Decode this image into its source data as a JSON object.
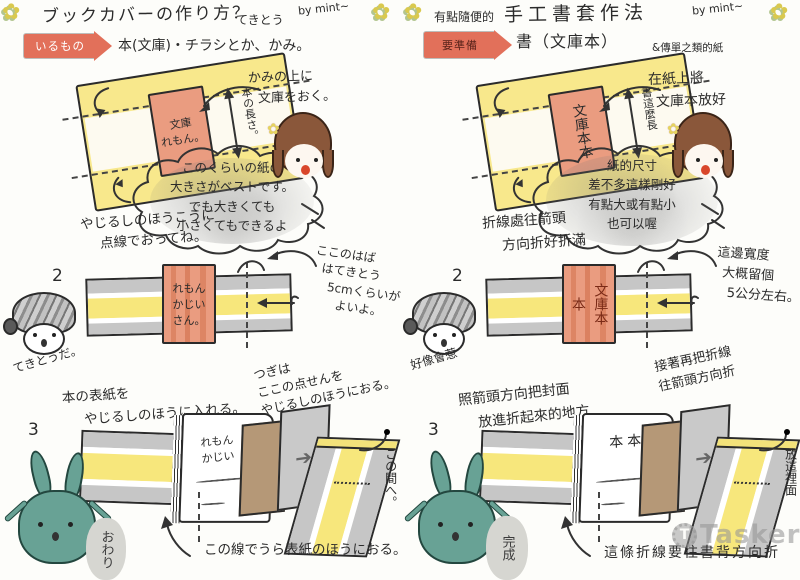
{
  "watermark": {
    "brand": "Tasker"
  },
  "icons": {
    "flower_doodle": "✿",
    "hand_drawn_arrow": "➔",
    "watermark_gear_letter": "T"
  },
  "colors": {
    "badge_red": "#e2705a",
    "paper_yellow": "#f8e88c",
    "book_pink": "#ea9c80",
    "band_gray": "#c6c6c6",
    "fold_tan": "#b59877",
    "rabbit_green": "#68a295",
    "hair_brown": "#8a573a"
  },
  "panels": [
    {
      "title_pre": "",
      "title_main": "ブックカバーの作り方？",
      "title_tail": "てきとう",
      "title_by": "by mint~",
      "badge": "いるもの",
      "materials_main": "本(文庫)・チラシとか、かみ。",
      "materials_sub": "",
      "step1_num": "1.",
      "step1_note1": "かみの上に",
      "step1_note2": "文庫をおく。",
      "step1_book": "文庫\nれもん。",
      "step1_length": "本の長さ。",
      "step1_fold1": "やじるしのほうこうに",
      "step1_fold2": "点線でおってね。",
      "cloud1": "このくらいの紙の",
      "cloud2": "大きさがベストです。",
      "cloud3": "でも大きくても",
      "cloud4": "小さくてもできるよ",
      "step2_num": "2",
      "step2_char": "てきとうだ。",
      "step2_book": "れもん\nかじい\nさん。",
      "step2_width1": "ここのはば",
      "step2_width2": "はてきとう",
      "step2_width3": "5cmくらいが",
      "step2_width4": "よいよ。",
      "step2_next1": "つぎは",
      "step2_next2": "ここの点せんを",
      "step2_next3": "やじるしのほうにおる。",
      "step2_insert1": "本の表紙を",
      "step2_insert2": "やじるしのほうに入れる。",
      "step3_num": "3",
      "step3_book": "れもん\nかじい",
      "step3_gap": "この間へ。",
      "step3_fold": "この線でうら表紙のほうにおる。",
      "step3_bubble": "おわり"
    },
    {
      "title_pre": "有點隨便的",
      "title_main": "手工書套作法",
      "title_tail": "",
      "title_by": "by mint~",
      "badge": "要準備",
      "materials_main": "書（文庫本）",
      "materials_sub": "&傳單之類的紙",
      "step1_num": "1.",
      "step1_note1": "在紙上將",
      "step1_note2": "文庫本放好",
      "step1_book": "文庫本本",
      "step1_length": "書這麼長",
      "step1_fold1": "折線處往箭頭",
      "step1_fold2": "方向折好折滿",
      "cloud1": "紙的尺寸",
      "cloud2": "差不多這樣剛好",
      "cloud3": "有點大或有點小",
      "cloud4": "也可以喔",
      "step2_num": "2",
      "step2_char": "好像會惹",
      "step2_book": "文庫本本",
      "step2_width1": "這邊寬度",
      "step2_width2": "大概留個",
      "step2_width3": "5公分左右。",
      "step2_width4": "",
      "step2_next1": "接著再把折線",
      "step2_next2": "往箭頭方向折",
      "step2_next3": "",
      "step2_insert1": "照箭頭方向把封面",
      "step2_insert2": "放進折起來的地方",
      "step3_num": "3",
      "step3_book": "本本",
      "step3_gap": "放這裡面",
      "step3_fold": "這條折線要往書背方向折",
      "step3_bubble": "完成"
    }
  ]
}
